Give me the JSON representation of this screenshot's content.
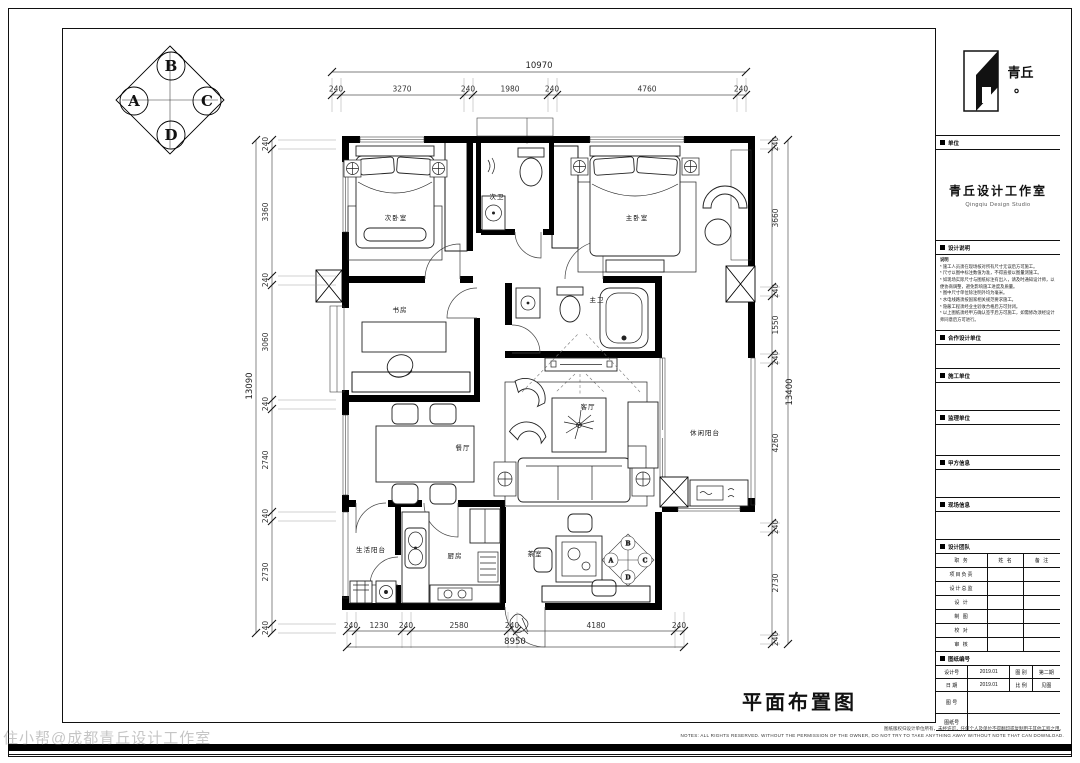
{
  "sheet": {
    "title": "平面布置图",
    "watermark": "住小帮@成都青丘设计工作室",
    "disclaimer_cn": "图纸版权归设计单位所有，未经许可，任何个人及单位不得翻印或复制用于其他工程之用。",
    "disclaimer_en": "NOTES: ALL RIGHTS RESERVED. WITHOUT THE PERMISSION OF THE OWNER, DO NOT TRY TO TAKE ANYTHING AWAY WITHOUT NOTE THAT CAN DOWNLOAD."
  },
  "compass": {
    "a": "A",
    "b": "B",
    "c": "C",
    "d": "D"
  },
  "rooms": {
    "bedroom2": "次卧室",
    "bath2": "次卫",
    "master": "主卧室",
    "study": "书房",
    "bath1": "主卫",
    "dining": "餐厅",
    "living": "客厅",
    "balcony_leisure": "休闲阳台",
    "balcony_service": "生活阳台",
    "kitchen": "厨房",
    "tea": "茶室"
  },
  "dims": {
    "top": {
      "total": "10970",
      "s": [
        "240",
        "3270",
        "240",
        "1980",
        "240",
        "4760",
        "240"
      ]
    },
    "bottom": {
      "total": "8950",
      "s": [
        "240",
        "1230",
        "240",
        "2580",
        "240",
        "4180",
        "240"
      ]
    },
    "left": {
      "total": "13090",
      "s": [
        "240",
        "3360",
        "240",
        "3060",
        "240",
        "2740",
        "240",
        "2730",
        "240"
      ]
    },
    "right": {
      "total": "13400",
      "s": [
        "240",
        "3660",
        "240",
        "1550",
        "240",
        "4260",
        "240",
        "2730",
        "240"
      ]
    }
  },
  "title_block": {
    "logo_cn": "青丘",
    "logo_dot": "。",
    "unit_label": "单位",
    "company_cn": "青丘设计工作室",
    "company_en": "Qingqiu Design Studio",
    "notes_label": "设计说明",
    "notes_title": "说明",
    "notes": [
      "* 施工人员须在现场核对所有尺寸无误后方可施工。",
      "* 尺寸以图中标注数值为准，不得直接以图量测施工。",
      "* 如现场实际尺寸与图纸标注有出入，请及时通知设计师，以便协商调整，避免影响施工进度及质量。",
      "* 图中尺寸单位除注明外均为毫米。",
      "* 水电线路须按国家相关规范要求施工。",
      "* 隐蔽工程须经业主验收合格后方可封闭。",
      "* 以上图纸须经甲方确认签字后方可施工，如需修改须经设计师同意后方可进行。"
    ],
    "sections": [
      {
        "label": "合作设计单位"
      },
      {
        "label": "施工单位"
      },
      {
        "label": "监理单位"
      },
      {
        "label": "甲方信息"
      },
      {
        "label": "现场信息"
      }
    ],
    "team_label": "设计团队",
    "table": {
      "headers": [
        "职 务",
        "姓 名",
        "备 注"
      ],
      "rows": [
        "项目负责",
        "设计总监",
        "设 计",
        "制 图",
        "校 对",
        "审 核"
      ]
    },
    "drawing_no_label": "图纸编号",
    "info_rows": [
      {
        "k1": "设计号",
        "v1": "2019.01",
        "k2": "图 别",
        "v2": "第二期"
      },
      {
        "k1": "日 期",
        "v1": "2019.01",
        "k2": "比 例",
        "v2": "见图"
      }
    ],
    "fig_no_label": "图 号",
    "version_label": "图纸号"
  }
}
